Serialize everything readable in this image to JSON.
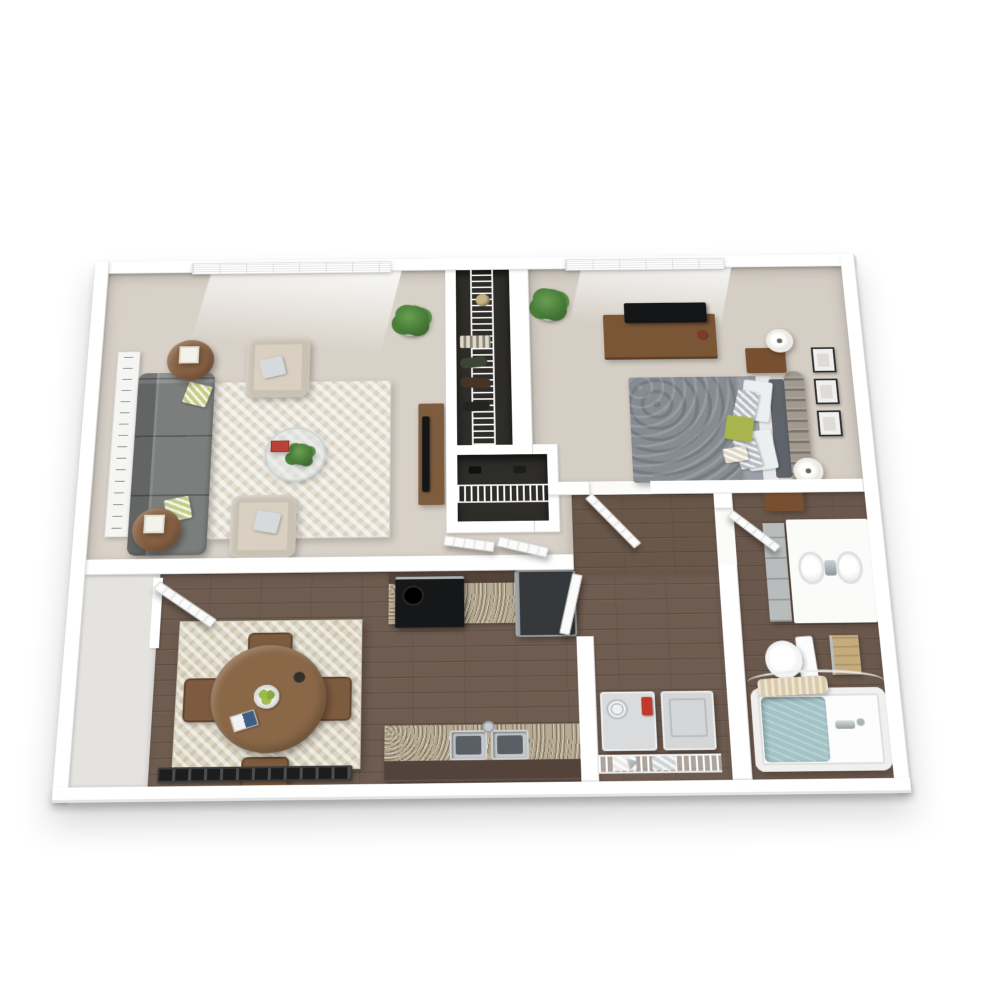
{
  "meta": {
    "title": "3D top-down floor plan of a one-bedroom, one-bathroom apartment",
    "style": "photoreal 3D render, white exterior walls, viewed from above with slight perspective"
  },
  "palette": {
    "wall": "#ffffff",
    "wall_face": "#e4e3e0",
    "carpet_living": "#d8d1c8",
    "carpet_bedroom": "#d5cec5",
    "wood": "#6e5c50",
    "wood_hall": "#695749",
    "wood_bath": "#6a584c",
    "closet_dark": "#2e2d29",
    "sofa_gray": "#7b7e7d",
    "armchair_cream": "#d9d0c1",
    "rug_living": "#e7e1d3",
    "rug_dining": "#ddd6c2",
    "side_table_wood": "#8a6244",
    "dining_table_wood": "#8a6847",
    "dining_chair_wood": "#7d5b3e",
    "tv_stand_wood": "#7e5c3e",
    "dresser_wood": "#7a5536",
    "nightstand_wood": "#774f31",
    "tv_black": "#141517",
    "bed_duvet_gray": "#878c93",
    "bed_band_gray": "#9aa0a7",
    "sheet_white": "#e9e9eb",
    "pillow_green": "#a8b54d",
    "pillow_silver": "#b8bcc2",
    "headboard_taupe": "#a29a8f",
    "cabinet_brown": "#54433a",
    "granite": "#b5a88e",
    "fridge_gray": "#35393b",
    "washer_gray": "#d9dbdc",
    "dryer_gray": "#d4d6d7",
    "detergent_red": "#c0392b",
    "tub_water": "#a3c3c6",
    "towel_tan": "#c6ab7d",
    "bath_mat_tan": "#d9cbaa",
    "vanity_white": "#fbfbfa",
    "linen_cabinet_gray": "#b9bcbd",
    "plant_green": "#4a7c3a",
    "lantern_white": "#f4f2ec",
    "door_white": "#fbfbfb"
  },
  "rooms": {
    "living_room": {
      "name": "living room",
      "floor": "beige carpet"
    },
    "bedroom": {
      "name": "bedroom",
      "floor": "beige carpet"
    },
    "hall_closet_tall": {
      "name": "hall closet with wire shelving",
      "floor": "dark"
    },
    "hall_closet_small": {
      "name": "shoe closet with wire shelf",
      "floor": "dark"
    },
    "hallway": {
      "name": "hallway",
      "floor": "carpet and wood"
    },
    "dining_area": {
      "name": "dining area",
      "floor": "dark wood planks"
    },
    "kitchen": {
      "name": "galley kitchen",
      "floor": "dark wood planks"
    },
    "laundry_closet": {
      "name": "laundry closet",
      "floor": "dark wood planks"
    },
    "bathroom": {
      "name": "bathroom",
      "floor": "dark wood planks"
    }
  },
  "inventory": {
    "living_room": [
      "window with white blinds",
      "script wall art canvas",
      "gray three-seat sofa",
      "two green-white accent pillows",
      "two round wood side tables with white lantern candles",
      "two cream armchairs with gray pillows",
      "cream herringbone area rug",
      "round glass coffee table with plant and red book",
      "potted plant",
      "wood TV stand with flat-screen TV"
    ],
    "bedroom": [
      "window with white blinds",
      "potted plant",
      "wood dresser with flat-screen TV",
      "queen bed with gray damask duvet",
      "white and silver pattern pillows",
      "green accent pillow",
      "tufted taupe headboard",
      "two wood nightstands with white lamps",
      "three framed pictures"
    ],
    "closets": [
      "wire shelving with hanging clothes",
      "sun hat",
      "striped blanket",
      "shoe rack shelf"
    ],
    "dining_area": [
      "entry door ajar",
      "round wood dining table",
      "four wood chairs",
      "patterned cream rug",
      "bowl of green apples",
      "open book",
      "baseboard heater"
    ],
    "kitchen": [
      "dark brown cabinet run",
      "granite countertops",
      "black four-burner range",
      "dark refrigerator",
      "double stainless sink with faucet",
      "white door to laundry hall"
    ],
    "laundry_closet": [
      "washer with dial and red detergent",
      "dryer",
      "wire shelf with folded towels"
    ],
    "bathroom": [
      "white double-sink vanity with chrome faucets",
      "gray linen cabinet",
      "toilet",
      "tan towels on rack",
      "bathtub with water",
      "chrome tub faucet",
      "tan bath mat",
      "curved shower curtain rod"
    ]
  }
}
